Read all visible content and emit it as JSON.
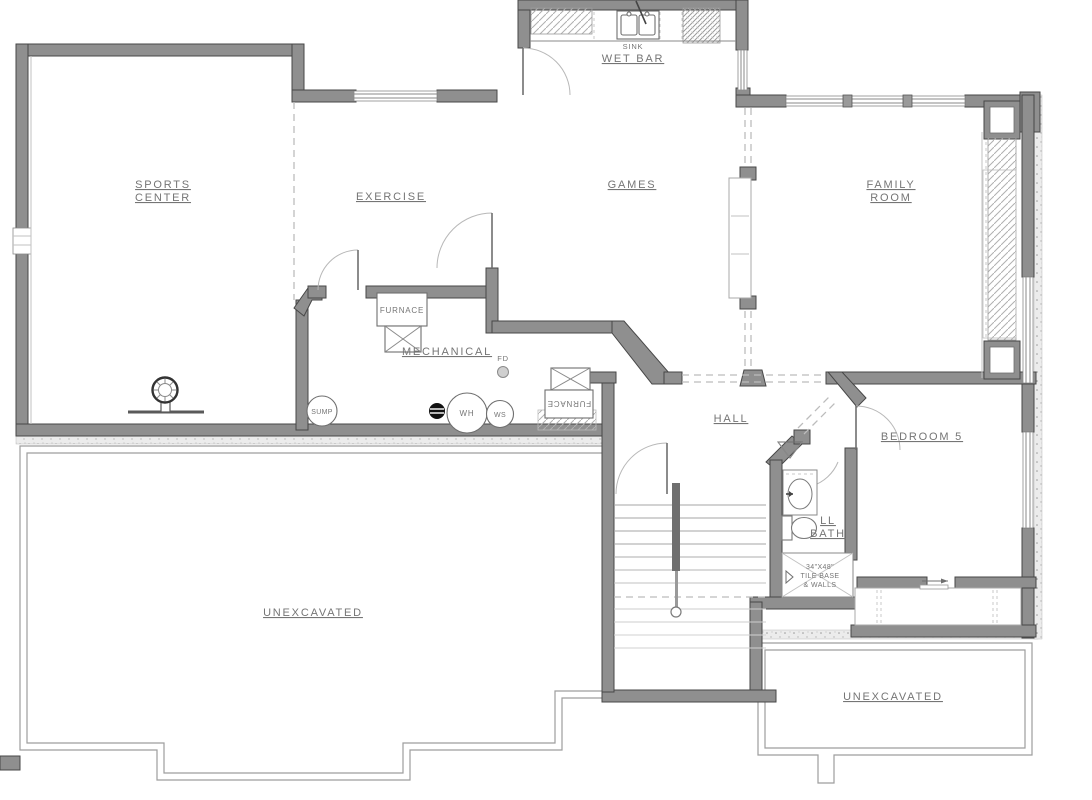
{
  "colors": {
    "wall": "#8f8f8f",
    "wall_outline": "#474747",
    "label_text": "#757575",
    "thin_line": "#8a8a8a",
    "background": "#ffffff"
  },
  "rooms": {
    "sports_center": {
      "line1": "SPORTS",
      "line2": "CENTER"
    },
    "exercise": {
      "label": "EXERCISE"
    },
    "games": {
      "label": "GAMES"
    },
    "family_room": {
      "line1": "FAMILY",
      "line2": "ROOM"
    },
    "wet_bar": {
      "label": "WET BAR",
      "sink": "SINK"
    },
    "mechanical": {
      "label": "MECHANICAL"
    },
    "hall": {
      "label": "HALL"
    },
    "bedroom5": {
      "label": "BEDROOM 5"
    },
    "ll_bath": {
      "line1": "LL",
      "line2": "BATH"
    },
    "unexcavated_left": {
      "label": "UNEXCAVATED"
    },
    "unexcavated_right": {
      "label": "UNEXCAVATED"
    }
  },
  "equipment": {
    "furnace1": "FURNACE",
    "furnace2": "FURNACE",
    "sump": "SUMP",
    "water_heater": "WH",
    "water_softener": "WS",
    "floor_drain": "FD",
    "shower": {
      "line1": "34\"X48\"",
      "line2": "TILE BASE",
      "line3": "& WALLS"
    }
  }
}
